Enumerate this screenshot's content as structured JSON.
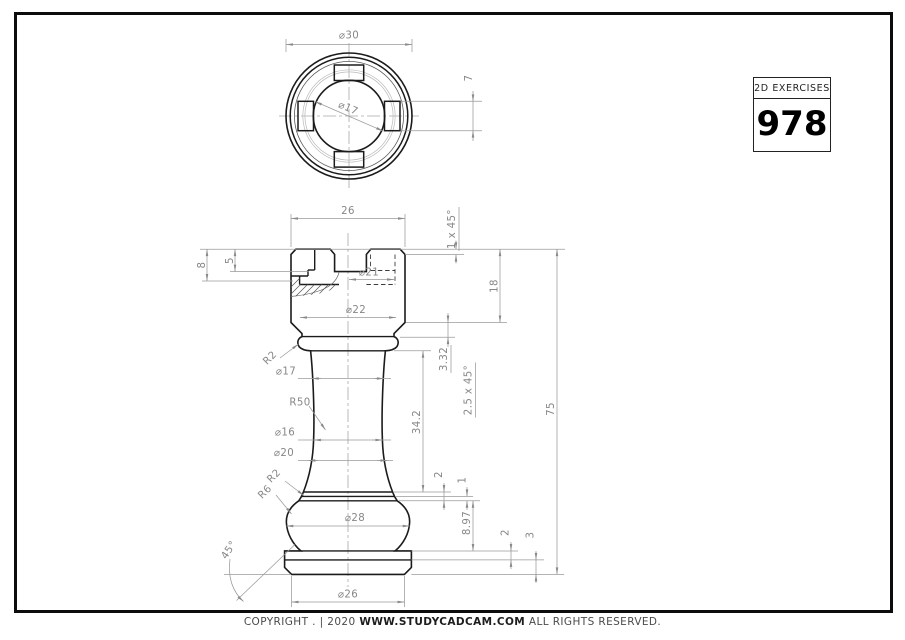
{
  "title_block": {
    "label": "2D EXERCISES",
    "number": "978"
  },
  "footer": {
    "prefix": "COPYRIGHT . | 2020",
    "site": "WWW.STUDYCADCAM.COM",
    "suffix": "ALL RIGHTS RESERVED."
  },
  "colors": {
    "object_line": "#1b1b1b",
    "dim_line": "#9a9a9a",
    "dim_text": "#878787",
    "border": "#0c0c0c"
  },
  "dimensions": {
    "top_view": {
      "outer_dia": "⌀30",
      "bore_dia": "⌀17",
      "slot_width": "7"
    },
    "front_view": {
      "head_width": "26",
      "head_chamfer": "1 x 45°",
      "bore_depth": "8",
      "slot_depth": "5",
      "dia21": "⌀21",
      "dia22": "⌀22",
      "head_height": "18",
      "bead_radius": "R2",
      "neck_top_dia": "⌀17",
      "chamfer_height": "3.32",
      "lower_chamfer": "2.5 x 45°",
      "neck_radius": "R50",
      "neck_height": "34.2",
      "neck_min_dia": "⌀16",
      "neck_bottom_dia": "⌀20",
      "collar_two": "2",
      "collar_one": "1",
      "fillet_r2": "R2",
      "fillet_r6": "R6",
      "bulge_dia": "⌀28",
      "base_curve_height": "8.97",
      "plinth_step": "2",
      "plinth_height": "3",
      "total_height": "75",
      "base_angle": "45°",
      "base_dia": "⌀26"
    }
  }
}
